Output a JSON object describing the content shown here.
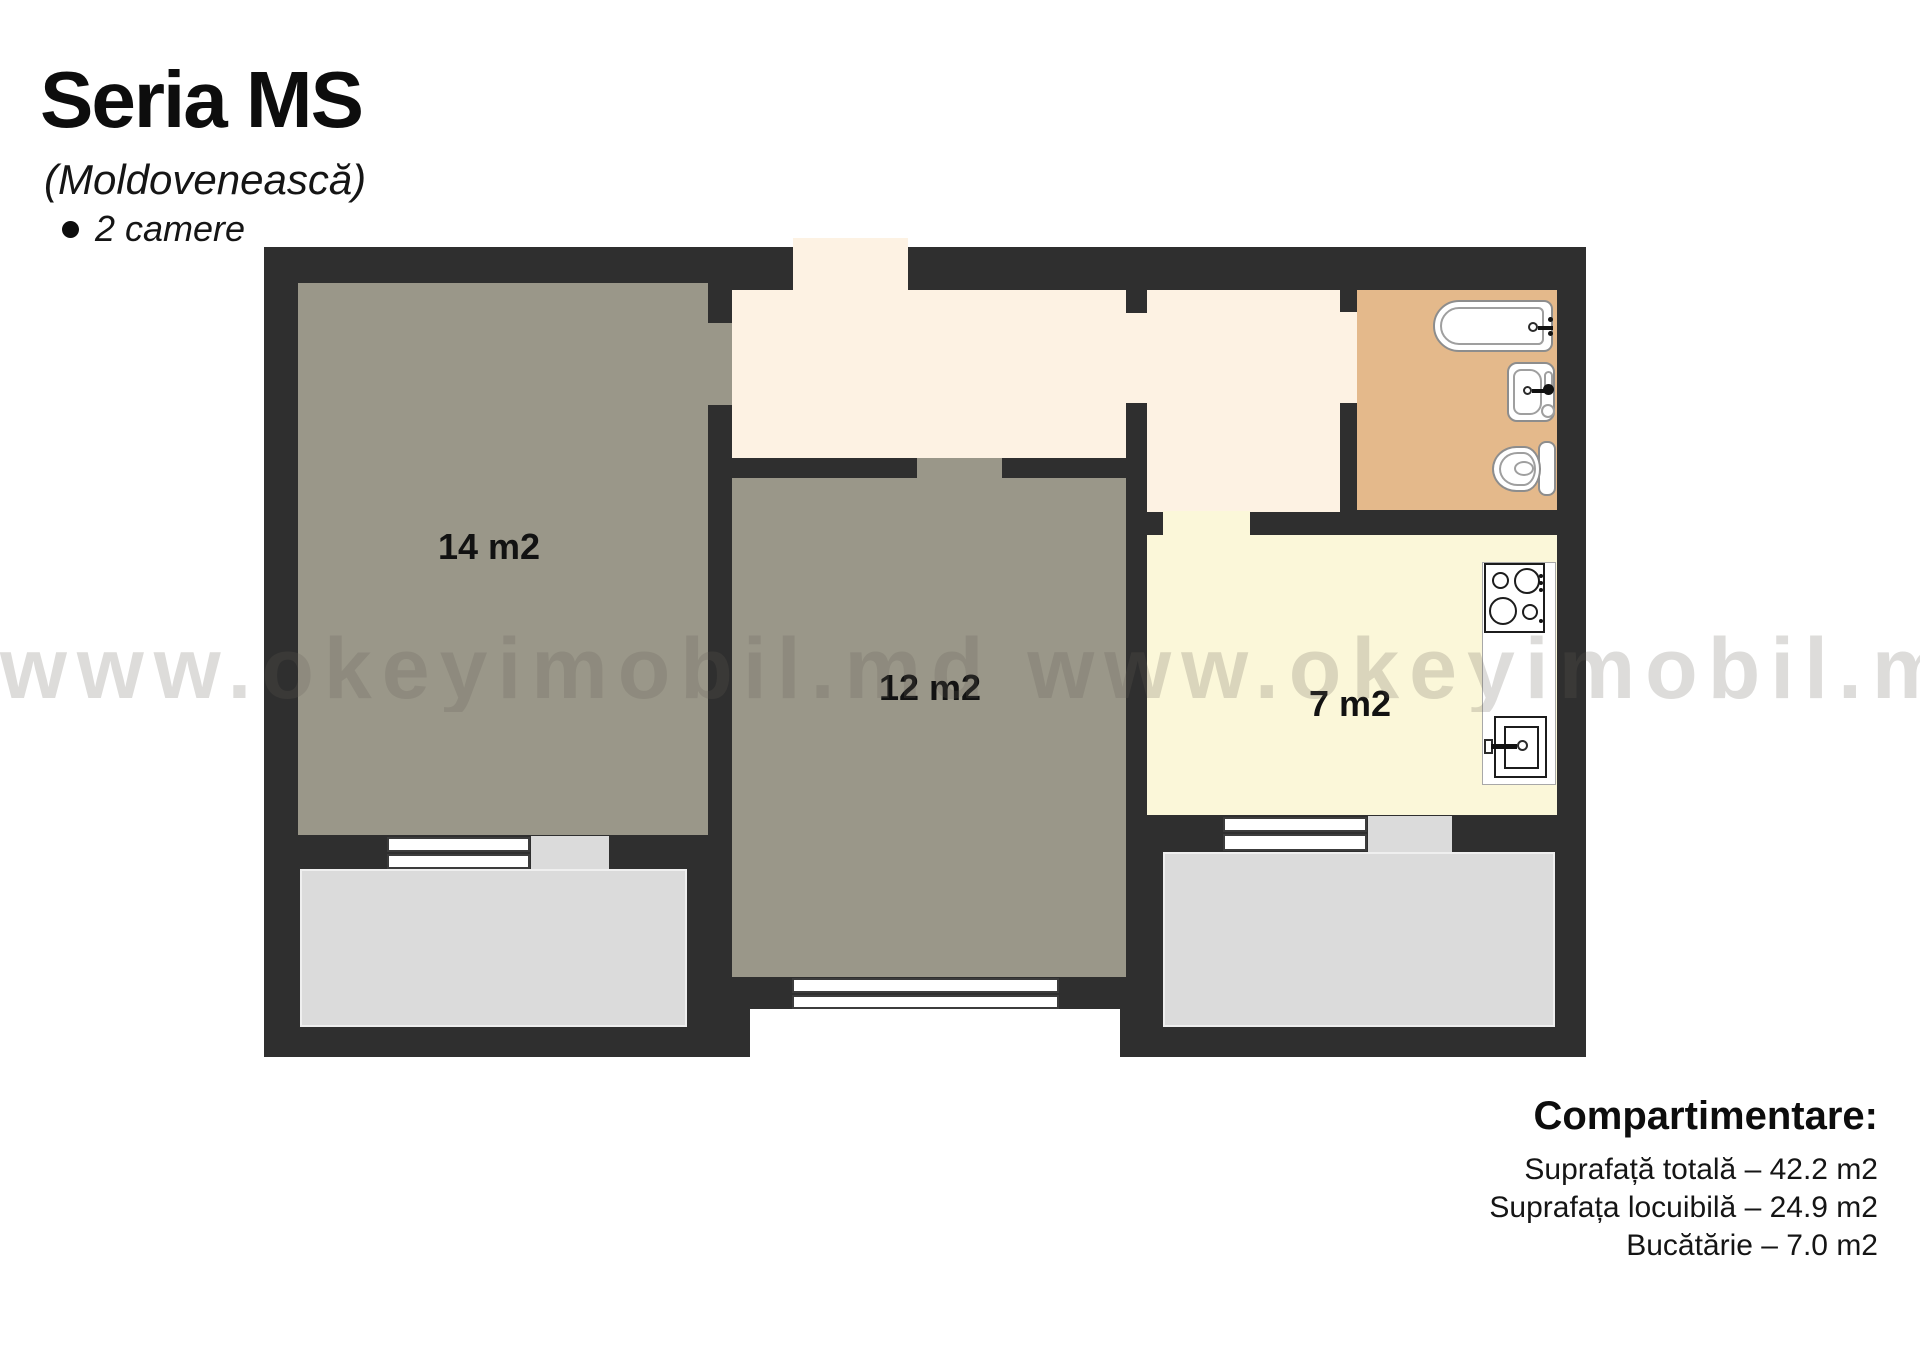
{
  "header": {
    "title": "Seria MS",
    "subtitle": "(Moldovenească)",
    "feature": "2 camere"
  },
  "watermark": {
    "text": "www.okeyimobil.md www.okeyimobil.md"
  },
  "plan": {
    "rooms": [
      {
        "name": "living-room-1",
        "label": "14 m2"
      },
      {
        "name": "living-room-2",
        "label": "12 m2"
      },
      {
        "name": "kitchen",
        "label": "7 m2"
      }
    ],
    "fixtures": [
      "bathtub-icon",
      "bathroom-sink-icon",
      "toilet-icon",
      "stove-icon",
      "kitchen-sink-icon"
    ],
    "colors": {
      "wall": "#2f2f2f",
      "room": "#9a9789",
      "hallway": "#fdf2e3",
      "kitchen": "#fbf7d9",
      "bathroom": "#e4b98b",
      "balcony": "#dbdbdb"
    }
  },
  "legend": {
    "heading": "Compartimentare:",
    "lines": [
      "Suprafață totală – 42.2 m2",
      "Suprafața locuibilă – 24.9 m2",
      "Bucătărie – 7.0 m2"
    ]
  }
}
